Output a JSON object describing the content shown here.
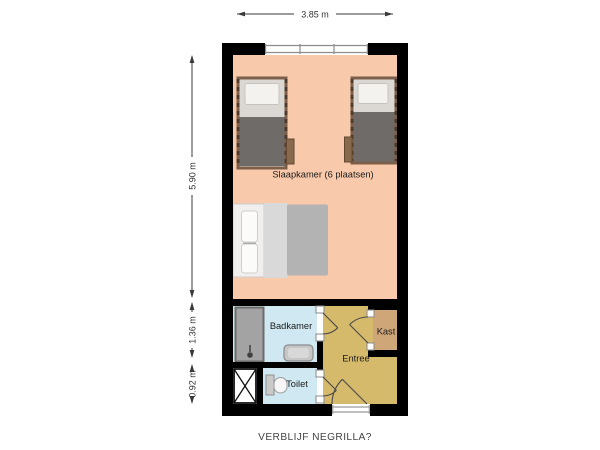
{
  "caption": "VERBLIJF NEGRILLA?",
  "dimensions": {
    "width_top": "3.85 m",
    "height_main": "5.90 m",
    "height_badkamer": "1.36 m",
    "height_toilet": "0.92 m"
  },
  "rooms": {
    "slaapkamer": {
      "label": "Slaapkamer (6 plaatsen)",
      "floor_color": "#f8c9ab"
    },
    "badkamer": {
      "label": "Badkamer",
      "floor_color": "#cfe8f1"
    },
    "toilet": {
      "label": "Toilet",
      "floor_color": "#cfe8f1"
    },
    "entree": {
      "label": "Entree",
      "floor_color": "#d6ba6b"
    },
    "kast": {
      "label": "Kast",
      "floor_color": "#cfa678"
    }
  },
  "colors": {
    "wall": "#000000",
    "background": "#ffffff",
    "dimension": "#3a3a3a",
    "bed_frame": "#7d5e49",
    "single_bed_blanket": "#6e6b68",
    "double_bed_blanket": "#b3b3b3",
    "shower": "#a3a3a3",
    "shaft": "#ffffff"
  },
  "furniture": {
    "single_beds": 2,
    "double_beds": 1,
    "fixtures": [
      "shower",
      "sink",
      "toilet",
      "shaft"
    ]
  }
}
